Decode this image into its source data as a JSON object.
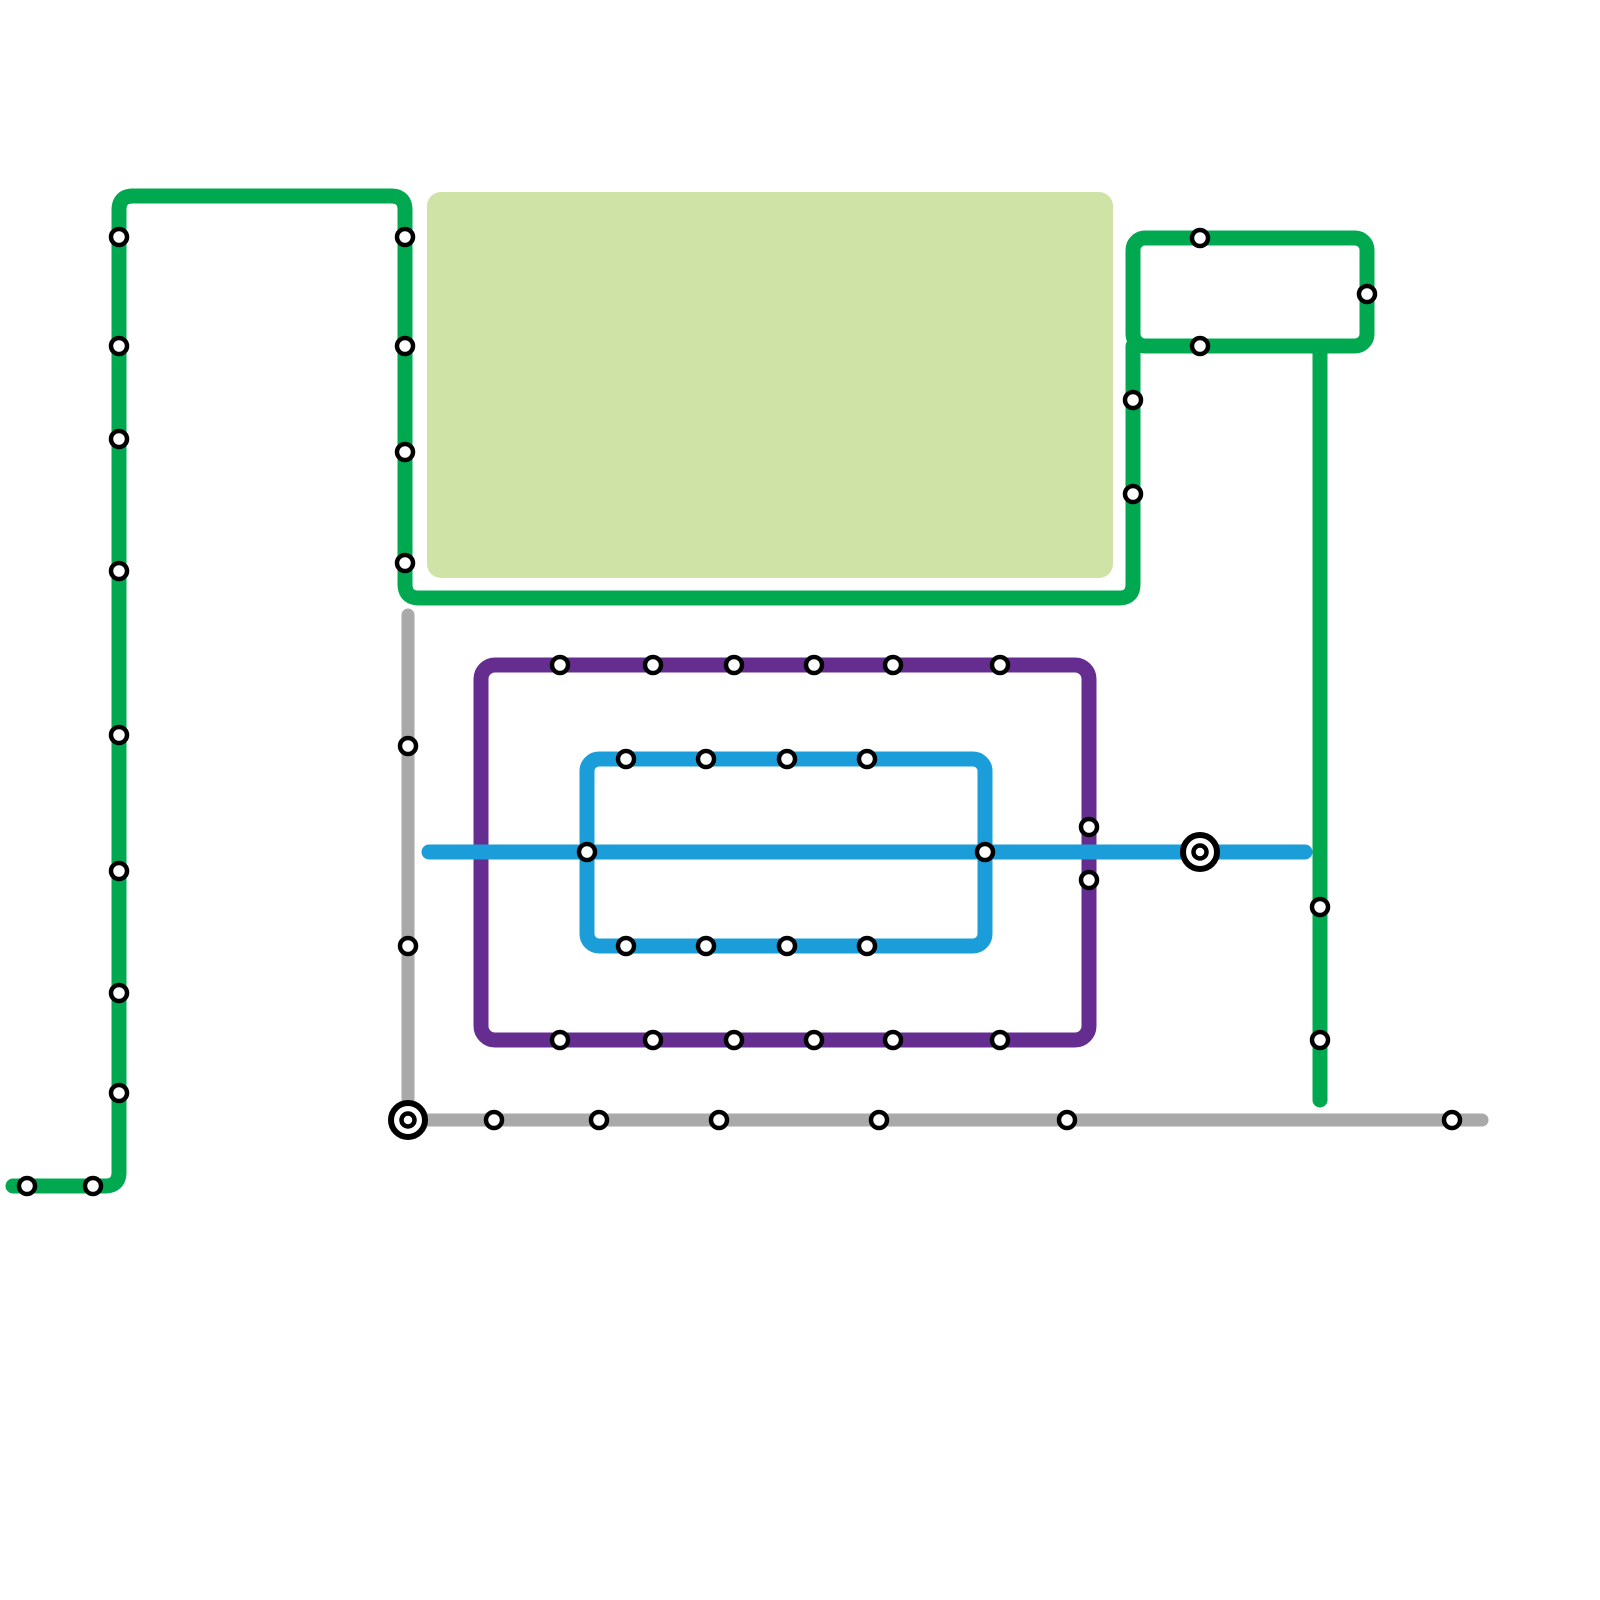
{
  "canvas": {
    "width": 1600,
    "height": 1600,
    "background": "#ffffff"
  },
  "park": {
    "x": 427,
    "y": 192,
    "width": 686,
    "height": 386,
    "radius": 14,
    "color": "#cfe3a6"
  },
  "colors": {
    "green": "#00a950",
    "purple": "#662d91",
    "blue": "#1b9dd9",
    "gray": "#a9a9a9"
  },
  "lines": [
    {
      "id": "green-main",
      "color": "green",
      "width": 15,
      "type": "path",
      "d": "M 13 1186 L 105 1186 Q 119 1186 119 1172 L 119 210 Q 119 196 133 196 L 391 196 Q 405 196 405 210 L 405 584 Q 405 598 419 598 L 1119 598 Q 1133 598 1133 584 L 1133 346"
    },
    {
      "id": "green-loop",
      "color": "green",
      "width": 15,
      "type": "rect",
      "x": 1133,
      "y": 238,
      "w": 234,
      "h": 108,
      "rx": 12
    },
    {
      "id": "green-branch",
      "color": "green",
      "width": 15,
      "type": "path",
      "d": "M 1320 350 L 1320 1100"
    },
    {
      "id": "gray-line",
      "color": "gray",
      "width": 13,
      "type": "path",
      "d": "M 408 615 L 408 1112 Q 408 1120 416 1120 L 1482 1120"
    },
    {
      "id": "purple-loop",
      "color": "purple",
      "width": 15,
      "type": "rect",
      "x": 481,
      "y": 665,
      "w": 608,
      "h": 375,
      "rx": 14
    },
    {
      "id": "blue-main",
      "color": "blue",
      "width": 15,
      "type": "path",
      "d": "M 429 852 L 1305 852"
    },
    {
      "id": "blue-loop",
      "color": "blue",
      "width": 15,
      "type": "rect",
      "x": 587,
      "y": 759,
      "w": 398,
      "h": 187,
      "rx": 12
    }
  ],
  "stations": [
    {
      "x": 119,
      "y": 237
    },
    {
      "x": 119,
      "y": 346
    },
    {
      "x": 119,
      "y": 439
    },
    {
      "x": 119,
      "y": 571
    },
    {
      "x": 119,
      "y": 735
    },
    {
      "x": 119,
      "y": 871
    },
    {
      "x": 119,
      "y": 993
    },
    {
      "x": 119,
      "y": 1093
    },
    {
      "x": 27,
      "y": 1186
    },
    {
      "x": 93,
      "y": 1186
    },
    {
      "x": 405,
      "y": 237
    },
    {
      "x": 405,
      "y": 346
    },
    {
      "x": 405,
      "y": 452
    },
    {
      "x": 405,
      "y": 563
    },
    {
      "x": 1133,
      "y": 400
    },
    {
      "x": 1133,
      "y": 494
    },
    {
      "x": 1200,
      "y": 238
    },
    {
      "x": 1367,
      "y": 294
    },
    {
      "x": 1200,
      "y": 346
    },
    {
      "x": 1320,
      "y": 907
    },
    {
      "x": 1320,
      "y": 1040
    },
    {
      "x": 408,
      "y": 746
    },
    {
      "x": 408,
      "y": 946
    },
    {
      "x": 494,
      "y": 1120
    },
    {
      "x": 599,
      "y": 1120
    },
    {
      "x": 719,
      "y": 1120
    },
    {
      "x": 879,
      "y": 1120
    },
    {
      "x": 1067,
      "y": 1120
    },
    {
      "x": 1452,
      "y": 1120
    },
    {
      "x": 560,
      "y": 665
    },
    {
      "x": 653,
      "y": 665
    },
    {
      "x": 734,
      "y": 665
    },
    {
      "x": 814,
      "y": 665
    },
    {
      "x": 893,
      "y": 665
    },
    {
      "x": 1000,
      "y": 665
    },
    {
      "x": 560,
      "y": 1040
    },
    {
      "x": 653,
      "y": 1040
    },
    {
      "x": 734,
      "y": 1040
    },
    {
      "x": 814,
      "y": 1040
    },
    {
      "x": 893,
      "y": 1040
    },
    {
      "x": 1000,
      "y": 1040
    },
    {
      "x": 1089,
      "y": 827
    },
    {
      "x": 1089,
      "y": 880
    },
    {
      "x": 626,
      "y": 759
    },
    {
      "x": 706,
      "y": 759
    },
    {
      "x": 787,
      "y": 759
    },
    {
      "x": 867,
      "y": 759
    },
    {
      "x": 626,
      "y": 946
    },
    {
      "x": 706,
      "y": 946
    },
    {
      "x": 787,
      "y": 946
    },
    {
      "x": 867,
      "y": 946
    },
    {
      "x": 587,
      "y": 852
    },
    {
      "x": 985,
      "y": 852
    }
  ],
  "interchanges": [
    {
      "x": 408,
      "y": 1120
    },
    {
      "x": 1200,
      "y": 852
    }
  ],
  "station_style": {
    "radius": 8,
    "ring": 4.5,
    "ring_color": "#000000",
    "fill": "#ffffff"
  },
  "interchange_style": {
    "outer_radius": 17,
    "outer_ring": 6,
    "inner_radius": 6.5,
    "inner_ring": 4.5,
    "ring_color": "#000000",
    "fill": "#ffffff"
  }
}
